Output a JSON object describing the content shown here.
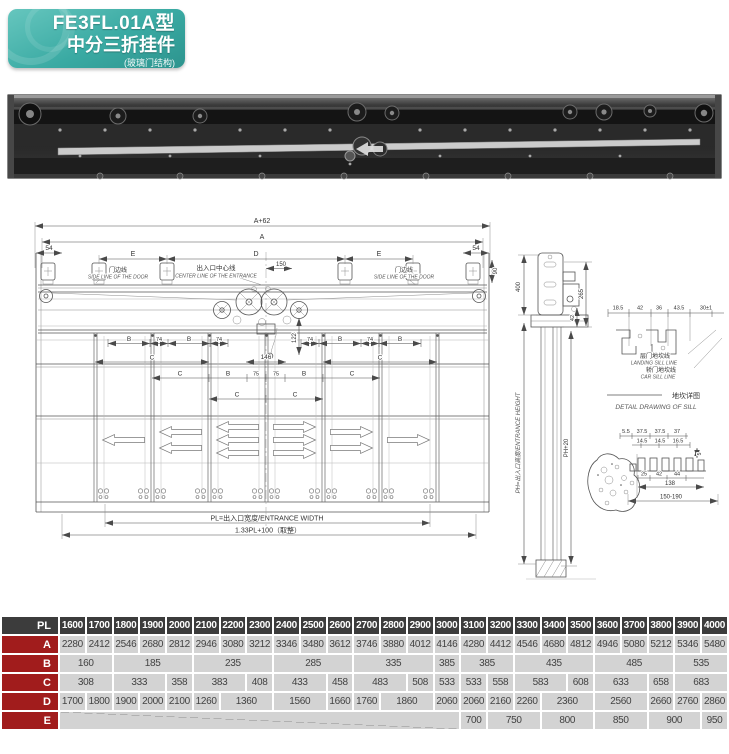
{
  "badge": {
    "model": "FE3FL.01A型",
    "name": "中分三折挂件",
    "sub": "(玻璃门结构)"
  },
  "drawing": {
    "front": {
      "dim_a62": "A+62",
      "dim_a": "A",
      "dim_54": "54",
      "dim_e": "E",
      "dim_d": "D",
      "dim_150": "150",
      "dim_90": "90",
      "side_line_cn": "门边线",
      "side_line_en": "SIDE LINE OF THE DOOR",
      "center_line_cn": "出入口中心线",
      "center_line_en": "CENTER LINE OF THE ENTRANCE",
      "dim_b": "B",
      "dim_74": "74",
      "dim_c": "C",
      "dim_75": "75",
      "dim_122": "122",
      "dim_146": "146",
      "entrance_width": "PL=出入口宽度/ENTRANCE WIDTH",
      "formula": "1.33PL+100（取整）"
    },
    "side": {
      "dim_400": "400",
      "dim_265": "265",
      "dim_42": "42",
      "dim_ph": "PH=出入口高度/ENTRANCE HEIGHT",
      "dim_ph20": "PH+20"
    },
    "sill": {
      "dims_top": [
        "18.5",
        "42",
        "36",
        "43.5",
        "30±1"
      ],
      "landing_cn": "层门地坎线",
      "landing_en": "LANDING SILL LINE",
      "car_cn": "轿门地坎线",
      "car_en": "CAR SILL LINE",
      "title_cn": "地坎详图",
      "title_en": "DETAIL DRAWING OF SILL",
      "detail": {
        "top": [
          "5.5",
          "37.5",
          "37.5",
          "37"
        ],
        "mid": [
          "14.5",
          "14.5",
          "16.5"
        ],
        "side": "5",
        "bottom": [
          "25",
          "42",
          "44"
        ],
        "width": "138",
        "range": "150-190"
      }
    }
  },
  "table": {
    "corner": "PL",
    "columns": [
      "1600",
      "1700",
      "1800",
      "1900",
      "2000",
      "2100",
      "2200",
      "2300",
      "2400",
      "2500",
      "2600",
      "2700",
      "2800",
      "2900",
      "3000",
      "3100",
      "3200",
      "3300",
      "3400",
      "3500",
      "3600",
      "3700",
      "3800",
      "3900",
      "4000"
    ],
    "rows": [
      {
        "label": "A",
        "cells": [
          {
            "v": "2280"
          },
          {
            "v": "2412"
          },
          {
            "v": "2546"
          },
          {
            "v": "2680"
          },
          {
            "v": "2812"
          },
          {
            "v": "2946"
          },
          {
            "v": "3080"
          },
          {
            "v": "3212"
          },
          {
            "v": "3346"
          },
          {
            "v": "3480"
          },
          {
            "v": "3612"
          },
          {
            "v": "3746"
          },
          {
            "v": "3880"
          },
          {
            "v": "4012"
          },
          {
            "v": "4146"
          },
          {
            "v": "4280"
          },
          {
            "v": "4412"
          },
          {
            "v": "4546"
          },
          {
            "v": "4680"
          },
          {
            "v": "4812"
          },
          {
            "v": "4946"
          },
          {
            "v": "5080"
          },
          {
            "v": "5212"
          },
          {
            "v": "5346"
          },
          {
            "v": "5480"
          }
        ]
      },
      {
        "label": "B",
        "cells": [
          {
            "v": "160",
            "span": 2
          },
          {
            "v": "185",
            "span": 3
          },
          {
            "v": "235",
            "span": 3
          },
          {
            "v": "285",
            "span": 3
          },
          {
            "v": "335",
            "span": 3
          },
          {
            "v": "385",
            "span": 1
          },
          {
            "v": "385",
            "span": 2
          },
          {
            "v": "435",
            "span": 3
          },
          {
            "v": "485",
            "span": 3
          },
          {
            "v": "535",
            "span": 2
          }
        ]
      },
      {
        "label": "C",
        "cells": [
          {
            "v": "308",
            "span": 2
          },
          {
            "v": "333",
            "span": 2
          },
          {
            "v": "358"
          },
          {
            "v": "383",
            "span": 2
          },
          {
            "v": "408"
          },
          {
            "v": "433",
            "span": 2
          },
          {
            "v": "458"
          },
          {
            "v": "483",
            "span": 2
          },
          {
            "v": "508"
          },
          {
            "v": "533"
          },
          {
            "v": "533"
          },
          {
            "v": "558"
          },
          {
            "v": "583",
            "span": 2
          },
          {
            "v": "608"
          },
          {
            "v": "633",
            "span": 2
          },
          {
            "v": "658"
          },
          {
            "v": "683",
            "span": 2
          }
        ]
      },
      {
        "label": "D",
        "cells": [
          {
            "v": "1700"
          },
          {
            "v": "1800"
          },
          {
            "v": "1900"
          },
          {
            "v": "2000"
          },
          {
            "v": "2100"
          },
          {
            "v": "1260"
          },
          {
            "v": "1360",
            "span": 2
          },
          {
            "v": "1560",
            "span": 2
          },
          {
            "v": "1660"
          },
          {
            "v": "1760"
          },
          {
            "v": "1860",
            "span": 2
          },
          {
            "v": "2060"
          },
          {
            "v": "2060"
          },
          {
            "v": "2160"
          },
          {
            "v": "2260"
          },
          {
            "v": "2360",
            "span": 2
          },
          {
            "v": "2560",
            "span": 2
          },
          {
            "v": "2660"
          },
          {
            "v": "2760"
          },
          {
            "v": "2860"
          }
        ]
      },
      {
        "label": "E",
        "cells": [
          {
            "v": "",
            "span": 15,
            "diag": true
          },
          {
            "v": "700"
          },
          {
            "v": "750",
            "span": 2
          },
          {
            "v": "800",
            "span": 2
          },
          {
            "v": "850",
            "span": 2
          },
          {
            "v": "900",
            "span": 2
          },
          {
            "v": "950"
          }
        ]
      }
    ]
  }
}
